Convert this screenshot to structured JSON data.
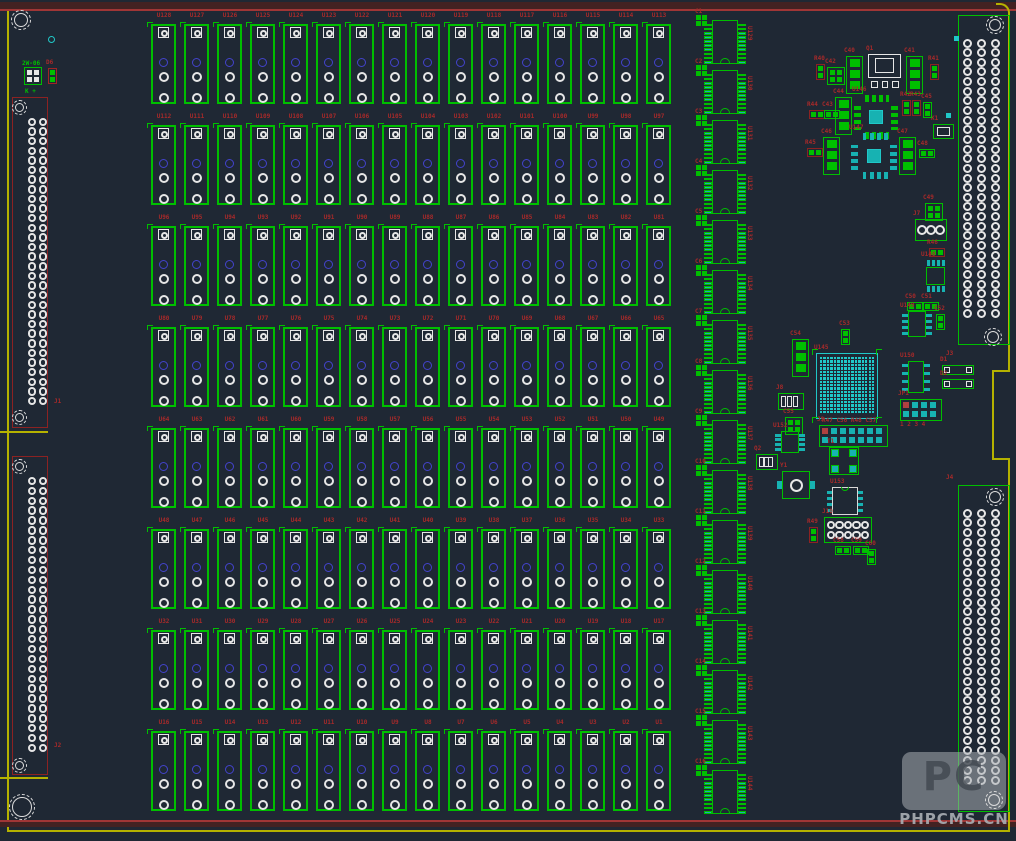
{
  "colors": {
    "background": "#1f2834",
    "green": "#00bf00",
    "cyan": "#17b2b2",
    "cyan_bright": "#20c8c8",
    "white": "#e6e6e6",
    "red_label": "#a62a2a",
    "red_outline": "#8c2222",
    "blue": "#4343cc",
    "yellow_edge": "#b5b200",
    "maroon_border": "#432222",
    "red_border_line": "#a03636",
    "watermark_gray": "#a8adb3"
  },
  "watermark": {
    "logo_text": "PC",
    "site_text": "PHPCMS.CN"
  },
  "relay_grid": {
    "rows": 8,
    "cols": 16,
    "labels": [
      "U128",
      "U127",
      "U126",
      "U125",
      "U124",
      "U123",
      "U122",
      "U121",
      "U120",
      "U119",
      "U118",
      "U117",
      "U116",
      "U115",
      "U114",
      "U113",
      "U112",
      "U111",
      "U110",
      "U109",
      "U108",
      "U107",
      "U106",
      "U105",
      "U104",
      "U103",
      "U102",
      "U101",
      "U100",
      "U99",
      "U98",
      "U97",
      "U96",
      "U95",
      "U94",
      "U93",
      "U92",
      "U91",
      "U90",
      "U89",
      "U88",
      "U87",
      "U86",
      "U85",
      "U84",
      "U83",
      "U82",
      "U81",
      "U80",
      "U79",
      "U78",
      "U77",
      "U76",
      "U75",
      "U74",
      "U73",
      "U72",
      "U71",
      "U70",
      "U69",
      "U68",
      "U67",
      "U66",
      "U65",
      "U64",
      "U63",
      "U62",
      "U61",
      "U60",
      "U59",
      "U58",
      "U57",
      "U56",
      "U55",
      "U54",
      "U53",
      "U52",
      "U51",
      "U50",
      "U49",
      "U48",
      "U47",
      "U46",
      "U45",
      "U44",
      "U43",
      "U42",
      "U41",
      "U40",
      "U39",
      "U38",
      "U37",
      "U36",
      "U35",
      "U34",
      "U33",
      "U32",
      "U31",
      "U30",
      "U29",
      "U28",
      "U27",
      "U26",
      "U25",
      "U24",
      "U23",
      "U22",
      "U21",
      "U20",
      "U19",
      "U18",
      "U17",
      "U16",
      "U15",
      "U14",
      "U13",
      "U12",
      "U11",
      "U10",
      "U9",
      "U8",
      "U7",
      "U6",
      "U5",
      "U4",
      "U3",
      "U2",
      "U1"
    ]
  },
  "ic_column": {
    "count": 16,
    "labels": [
      "U129",
      "U130",
      "U131",
      "U132",
      "U133",
      "U134",
      "U135",
      "U136",
      "U137",
      "U138",
      "U139",
      "U140",
      "U141",
      "U142",
      "U143",
      "U144"
    ],
    "cap_labels": [
      "C1",
      "C2",
      "C3",
      "C4",
      "C5",
      "C6",
      "C7",
      "C8",
      "C9",
      "C10",
      "C11",
      "C12",
      "C13",
      "C14",
      "C15",
      "C16"
    ]
  },
  "connectors": {
    "left": [
      {
        "label": "J1",
        "x": 12,
        "y": 97,
        "w": 36,
        "h": 331,
        "rows": 30,
        "cols": 2,
        "lx": 54,
        "ly": 398
      },
      {
        "label": "J2",
        "x": 12,
        "y": 456,
        "w": 36,
        "h": 319,
        "rows": 28,
        "cols": 2,
        "lx": 54,
        "ly": 742
      }
    ],
    "right": [
      {
        "label": "J3",
        "x": 958,
        "y": 15,
        "w": 52,
        "h": 330,
        "rows": 29,
        "cols": 3,
        "lx": 946,
        "ly": 350
      },
      {
        "label": "J4",
        "x": 958,
        "y": 485,
        "w": 52,
        "h": 327,
        "rows": 28,
        "cols": 3,
        "lx": 946,
        "ly": 474
      }
    ]
  },
  "mount_holes": [
    {
      "x": 21,
      "y": 20,
      "r": 10
    },
    {
      "x": 19,
      "y": 107,
      "r": 7.5
    },
    {
      "x": 19,
      "y": 417,
      "r": 7.5
    },
    {
      "x": 19,
      "y": 466,
      "r": 7.5
    },
    {
      "x": 19,
      "y": 765,
      "r": 7.5
    },
    {
      "x": 22,
      "y": 807,
      "r": 13
    },
    {
      "x": 995,
      "y": 25,
      "r": 9
    },
    {
      "x": 993,
      "y": 337,
      "r": 9
    },
    {
      "x": 995,
      "y": 497,
      "r": 9
    },
    {
      "x": 994,
      "y": 800,
      "r": 9
    }
  ],
  "components": [
    {
      "t": "cring",
      "x": 48,
      "y": 36
    },
    {
      "t": "glabel",
      "x": 22,
      "y": 60,
      "text": "2W-06"
    },
    {
      "t": "cap4",
      "x": 24,
      "y": 67,
      "pc": "#e6e6e6",
      "label": ""
    },
    {
      "t": "cap2",
      "x": 48,
      "y": 68,
      "dir": "v",
      "label": "D6",
      "oc": "#a02424"
    },
    {
      "t": "glabel",
      "x": 25,
      "y": 88,
      "text": "K +"
    },
    {
      "t": "csq",
      "x": 954,
      "y": 36
    },
    {
      "t": "white2",
      "x": 933,
      "y": 124,
      "label": "K1"
    },
    {
      "t": "csq",
      "x": 946,
      "y": 113
    },
    {
      "t": "res2",
      "x": 816,
      "y": 64,
      "dir": "v",
      "label": "R40"
    },
    {
      "t": "cap4",
      "x": 827,
      "y": 67,
      "label": "C42"
    },
    {
      "t": "sot3",
      "x": 846,
      "y": 56,
      "label": "C40"
    },
    {
      "t": "dpak",
      "x": 868,
      "y": 54,
      "label": "Q1"
    },
    {
      "t": "sot3",
      "x": 906,
      "y": 56,
      "label": "C41"
    },
    {
      "t": "res2",
      "x": 930,
      "y": 64,
      "dir": "v",
      "label": "R41"
    },
    {
      "t": "res2",
      "x": 809,
      "y": 110,
      "dir": "h",
      "label": "R44"
    },
    {
      "t": "cap2",
      "x": 824,
      "y": 110,
      "dir": "h",
      "label": "C43"
    },
    {
      "t": "sot3",
      "x": 835,
      "y": 97,
      "label": "C44"
    },
    {
      "t": "qfp",
      "x": 854,
      "y": 95,
      "s": 44,
      "pads": "green",
      "label": "U146"
    },
    {
      "t": "res2",
      "x": 902,
      "y": 100,
      "dir": "v",
      "label": "R42"
    },
    {
      "t": "res2",
      "x": 912,
      "y": 100,
      "dir": "v",
      "label": "R43"
    },
    {
      "t": "cap2",
      "x": 923,
      "y": 102,
      "dir": "v",
      "label": "C45"
    },
    {
      "t": "res2",
      "x": 807,
      "y": 148,
      "dir": "h",
      "label": "R45"
    },
    {
      "t": "sot3",
      "x": 823,
      "y": 137,
      "label": "C46"
    },
    {
      "t": "qfp",
      "x": 851,
      "y": 133,
      "s": 46,
      "pads": "cyan",
      "label": "U147"
    },
    {
      "t": "sot3",
      "x": 899,
      "y": 137,
      "label": "C47"
    },
    {
      "t": "cap2",
      "x": 919,
      "y": 149,
      "dir": "h",
      "label": "C48"
    },
    {
      "t": "cap4",
      "x": 925,
      "y": 203,
      "label": "C49"
    },
    {
      "t": "header3",
      "x": 915,
      "y": 219,
      "label": "J7"
    },
    {
      "t": "res2",
      "x": 929,
      "y": 248,
      "dir": "h",
      "label": "R46"
    },
    {
      "t": "soic8v",
      "x": 923,
      "y": 260,
      "label": "U148"
    },
    {
      "t": "cap2",
      "x": 907,
      "y": 302,
      "dir": "h",
      "label": "C50"
    },
    {
      "t": "cap2",
      "x": 923,
      "y": 302,
      "dir": "h",
      "label": "C51"
    },
    {
      "t": "soic8s",
      "x": 902,
      "y": 311,
      "w": 30,
      "h": 26,
      "label": "U149"
    },
    {
      "t": "cap2",
      "x": 936,
      "y": 314,
      "dir": "v",
      "label": "C52"
    },
    {
      "t": "soic8s",
      "x": 902,
      "y": 361,
      "w": 28,
      "h": 32,
      "label": "U150"
    },
    {
      "t": "diode",
      "x": 942,
      "y": 365,
      "label": "D1"
    },
    {
      "t": "diode",
      "x": 942,
      "y": 379,
      "label": "D2"
    },
    {
      "t": "sqheader",
      "x": 900,
      "y": 399,
      "rows": 2,
      "cols": 4,
      "label": "JP1"
    },
    {
      "t": "rlabel",
      "x": 900,
      "y": 421,
      "text": "1 2 3 4"
    },
    {
      "t": "cap2",
      "x": 841,
      "y": 329,
      "dir": "v",
      "label": "C53"
    },
    {
      "t": "sot3",
      "x": 792,
      "y": 339,
      "label": "C54"
    },
    {
      "t": "tab3",
      "x": 778,
      "y": 393,
      "w": 26,
      "h": 17,
      "label": "J8"
    },
    {
      "t": "cap4",
      "x": 785,
      "y": 417,
      "label": "C55"
    },
    {
      "t": "soic8s",
      "x": 775,
      "y": 431,
      "w": 30,
      "h": 22,
      "label": "U152"
    },
    {
      "t": "tab3",
      "x": 756,
      "y": 454,
      "w": 22,
      "h": 16,
      "label": "Q2"
    },
    {
      "t": "xtal",
      "x": 782,
      "y": 471,
      "label": "Y1"
    },
    {
      "t": "bga",
      "x": 816,
      "y": 353,
      "w": 62,
      "h": 66,
      "label": "U145"
    },
    {
      "t": "rlabel",
      "x": 822,
      "y": 417,
      "text": "R47 C56 R48 C57"
    },
    {
      "t": "sqheader",
      "x": 819,
      "y": 425,
      "rows": 2,
      "cols": 7,
      "label": "J9"
    },
    {
      "t": "quad4",
      "x": 829,
      "y": 447,
      "label": "T1"
    },
    {
      "t": "dip8",
      "x": 832,
      "y": 487,
      "label": "U153"
    },
    {
      "t": "header10",
      "x": 824,
      "y": 517,
      "label": "J10"
    },
    {
      "t": "res2",
      "x": 809,
      "y": 527,
      "dir": "v",
      "label": "R49"
    },
    {
      "t": "cap2",
      "x": 835,
      "y": 546,
      "dir": "h",
      "label": "C58"
    },
    {
      "t": "cap2",
      "x": 853,
      "y": 546,
      "dir": "h",
      "label": "C59"
    },
    {
      "t": "cap2",
      "x": 867,
      "y": 549,
      "dir": "v",
      "label": "C60"
    }
  ]
}
